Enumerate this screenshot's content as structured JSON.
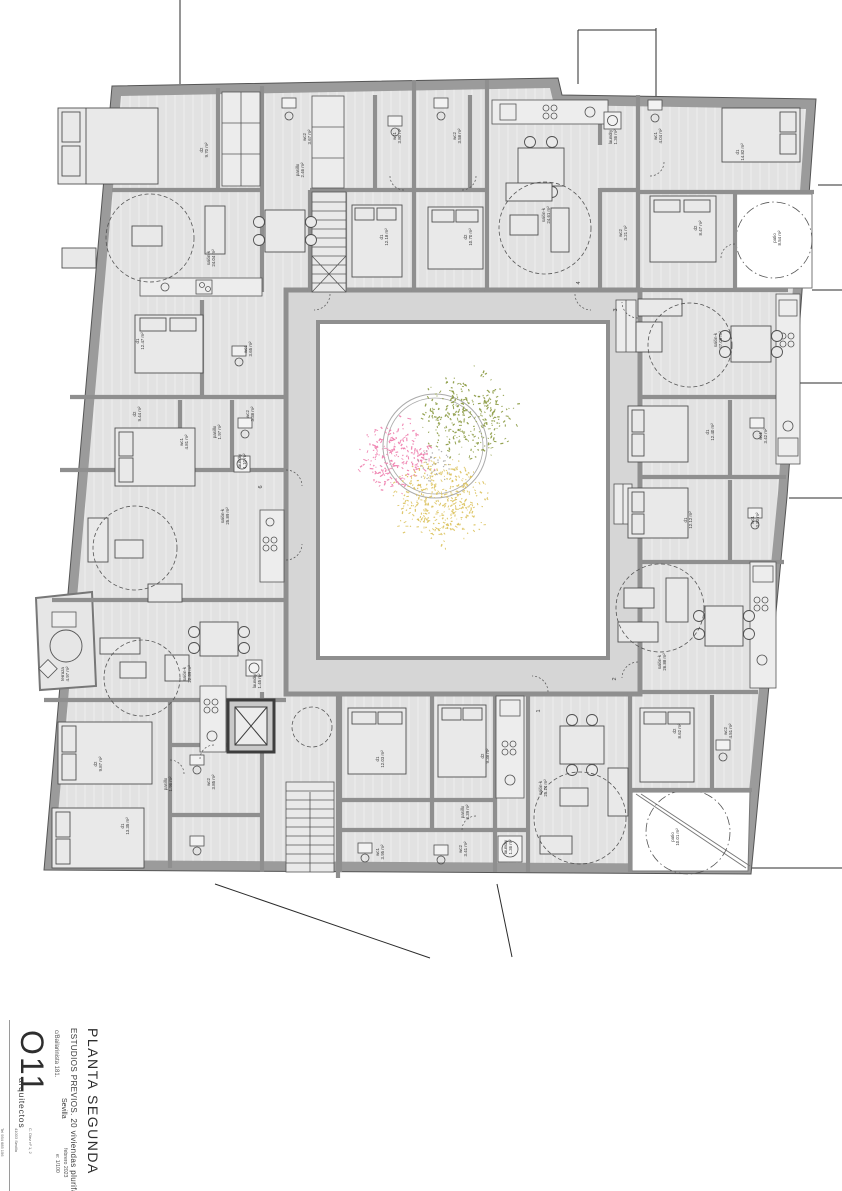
{
  "title_block": {
    "plan_name": "PLANTA SEGUNDA",
    "project": "ESTUDIOS PREVIOS. 20 viviendas plurifamiliares",
    "city": "Sevilla",
    "address": "c/Bailarinista 181.",
    "logo": "O11",
    "logo_sub": "arquitectos",
    "date": "febrero 2023",
    "scale": "e: 1/100",
    "office_lines": [
      "C. Diez nº 1, 2",
      "41003 Sevilla",
      "Tel 954 685 156",
      "estudio@o11arquitectos.es"
    ]
  },
  "colors": {
    "wall": "#8f8f8f",
    "floor": "#e2e2e2",
    "corridor": "#d6d6d6",
    "line": "#4a4a4a",
    "label": "#3a3a3a",
    "tree_green": "#8a9a41",
    "tree_pink": "#ef7fae",
    "tree_yellow": "#dcc35f"
  },
  "plan": {
    "rooms": [
      {
        "name": "d2",
        "area": "9.70 m²",
        "x": 203,
        "y": 150
      },
      {
        "name": "wc2",
        "area": "3.67 m²",
        "x": 306,
        "y": 137
      },
      {
        "name": "pasillo",
        "area": "2.46 m²",
        "x": 299,
        "y": 170
      },
      {
        "name": "salón-k",
        "area": "24.04 m²",
        "x": 210,
        "y": 258
      },
      {
        "name": "wc1",
        "area": "3.80 m²",
        "x": 396,
        "y": 136
      },
      {
        "name": "d1",
        "area": "12.18 m²",
        "x": 383,
        "y": 237
      },
      {
        "name": "wc2",
        "area": "3.58 m²",
        "x": 456,
        "y": 136
      },
      {
        "name": "d2",
        "area": "10.70 m²",
        "x": 467,
        "y": 237
      },
      {
        "name": "salón-k",
        "area": "24.61 m²",
        "x": 545,
        "y": 215
      },
      {
        "name": "laundry",
        "area": "1.36 m²",
        "x": 612,
        "y": 137
      },
      {
        "name": "wc2",
        "area": "3.21 m²",
        "x": 622,
        "y": 233
      },
      {
        "name": "wc1",
        "area": "4.04 m²",
        "x": 657,
        "y": 136
      },
      {
        "name": "d1",
        "area": "14.82 m²",
        "x": 739,
        "y": 152
      },
      {
        "name": "d2",
        "area": "8.47 m²",
        "x": 697,
        "y": 228
      },
      {
        "name": "patio",
        "area": "8.54 m²",
        "x": 776,
        "y": 238
      },
      {
        "name": "salón-k",
        "area": "27.05 m²",
        "x": 717,
        "y": 340
      },
      {
        "name": "d1",
        "area": "12.40 m²",
        "x": 709,
        "y": 432
      },
      {
        "name": "wc1",
        "area": "3.42 m²",
        "x": 762,
        "y": 436
      },
      {
        "name": "d1",
        "area": "12.12 m²",
        "x": 687,
        "y": 520
      },
      {
        "name": "wc1",
        "area": "3.90 m²",
        "x": 754,
        "y": 520
      },
      {
        "name": "salón-k",
        "area": "26.88 m²",
        "x": 661,
        "y": 662
      },
      {
        "name": "d2",
        "area": "8.62 m²",
        "x": 676,
        "y": 731
      },
      {
        "name": "wc2",
        "area": "4.51 m²",
        "x": 727,
        "y": 731
      },
      {
        "name": "patio",
        "area": "10.01 m²",
        "x": 674,
        "y": 837
      },
      {
        "name": "salón-k",
        "area": "25.17 m²",
        "x": 542,
        "y": 788
      },
      {
        "name": "laundry",
        "area": "1.36 m²",
        "x": 507,
        "y": 847
      },
      {
        "name": "wc2",
        "area": "3.41 m²",
        "x": 462,
        "y": 849
      },
      {
        "name": "pasillo",
        "area": "3.39 m²",
        "x": 464,
        "y": 812
      },
      {
        "name": "d2",
        "area": "9.38 m²",
        "x": 484,
        "y": 756
      },
      {
        "name": "d1",
        "area": "12.03 m²",
        "x": 379,
        "y": 759
      },
      {
        "name": "wc1",
        "area": "3.95 m²",
        "x": 379,
        "y": 852
      },
      {
        "name": "d1",
        "area": "13.35 m²",
        "x": 124,
        "y": 826
      },
      {
        "name": "d2",
        "area": "9.87 m²",
        "x": 97,
        "y": 764
      },
      {
        "name": "pasillo",
        "area": "1.96 m²",
        "x": 167,
        "y": 784
      },
      {
        "name": "wc2",
        "area": "3.85 m²",
        "x": 210,
        "y": 782
      },
      {
        "name": "salón-k",
        "area": "22.89 m²",
        "x": 186,
        "y": 674
      },
      {
        "name": "terraza",
        "area": "4.97 m²",
        "x": 64,
        "y": 674
      },
      {
        "name": "laundry",
        "area": "1.45 m²",
        "x": 256,
        "y": 681
      },
      {
        "name": "d1",
        "area": "12.47 m²",
        "x": 139,
        "y": 341
      },
      {
        "name": "wc1",
        "area": "3.65 m²",
        "x": 247,
        "y": 349
      },
      {
        "name": "d2",
        "area": "9.44 m²",
        "x": 136,
        "y": 414
      },
      {
        "name": "pasillo",
        "area": "1.97 m²",
        "x": 216,
        "y": 432
      },
      {
        "name": "wc1",
        "area": "4.81 m²",
        "x": 183,
        "y": 442
      },
      {
        "name": "wc2",
        "area": "3.38 m²",
        "x": 249,
        "y": 414
      },
      {
        "name": "laundry",
        "area": "1.10 m²",
        "x": 241,
        "y": 461
      },
      {
        "name": "salón-k",
        "area": "25.89 m²",
        "x": 224,
        "y": 516
      }
    ],
    "apartment_numbers": [
      {
        "value": "1",
        "x": 540,
        "y": 711
      },
      {
        "value": "2",
        "x": 616,
        "y": 679
      },
      {
        "value": "3",
        "x": 617,
        "y": 310
      },
      {
        "value": "4",
        "x": 580,
        "y": 283
      },
      {
        "value": "6",
        "x": 262,
        "y": 487
      }
    ],
    "tree": {
      "cx": 435,
      "cy": 446,
      "r_outer": 52,
      "r_inner": 48,
      "clusters": [
        {
          "color_key": "tree_green",
          "cx": 468,
          "cy": 414,
          "spread": 54,
          "count": 300,
          "len": 2.4
        },
        {
          "color_key": "tree_pink",
          "cx": 397,
          "cy": 456,
          "spread": 44,
          "count": 210,
          "len": 3.2
        },
        {
          "color_key": "tree_yellow",
          "cx": 441,
          "cy": 500,
          "spread": 52,
          "count": 400,
          "len": 2.2
        }
      ]
    }
  }
}
